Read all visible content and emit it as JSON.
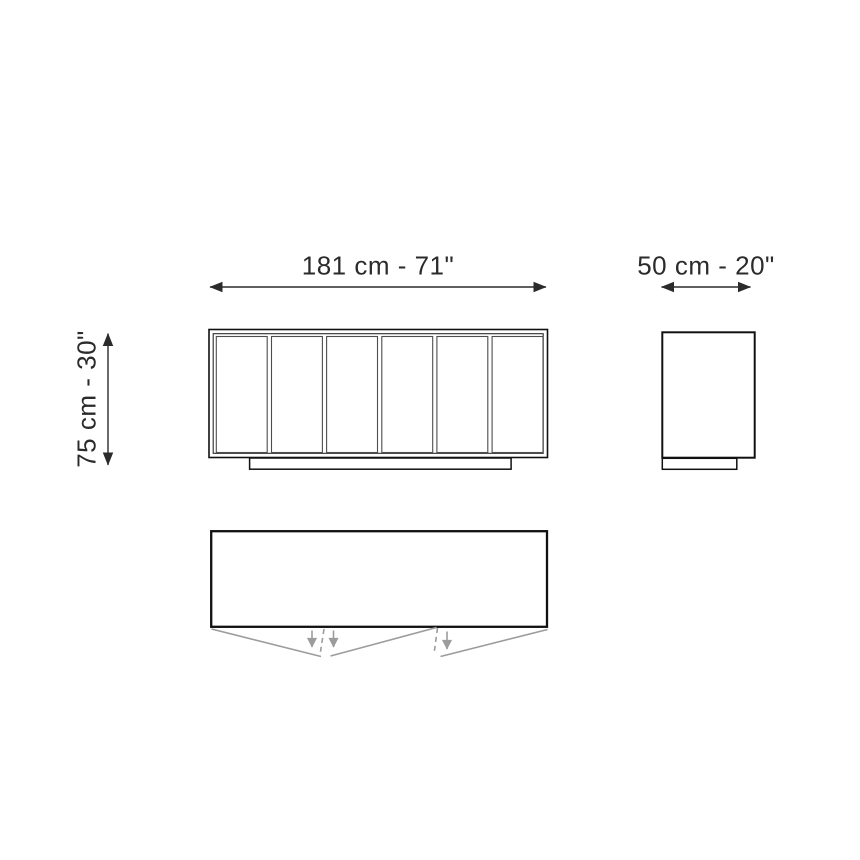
{
  "dimensions": {
    "width_label": "181 cm - 71\"",
    "depth_label": "50 cm - 20\"",
    "height_label": "75 cm - 30\""
  },
  "views": {
    "front": {
      "door_panels": 6
    },
    "top": {
      "door_open_arrows": 3
    }
  },
  "colors": {
    "line_black": "#111111",
    "line_dark": "#2b2b2b",
    "divider_gray": "#4d4d4d",
    "door_swing_gray": "#9c9c9c",
    "background": "#ffffff"
  }
}
